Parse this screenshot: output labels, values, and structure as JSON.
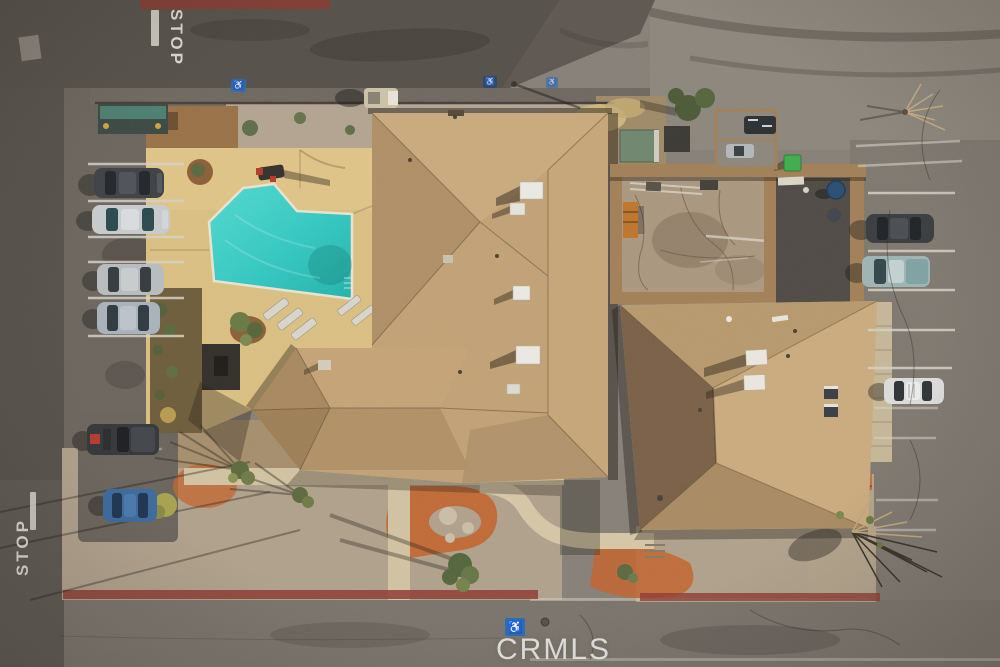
{
  "scene": {
    "description": "Aerial drone view of a motel property: swimming pool with tan deck, large hip-roof building, walled service courtyard, second hip-roof building, perimeter parking lots with cars, desert landscaping with orange ground cover",
    "watermark": "CRMLS"
  },
  "markings": {
    "stop_top": "STOP",
    "stop_bottom": "STOP",
    "accessible_icon": "♿"
  },
  "site_colors": {
    "pool_water": "#35c9c2",
    "pool_deck": "#dcc083",
    "roof_shingle": "#c3a276",
    "roof_shadow_facet": "#7b6148",
    "gravel": "#b1a28c",
    "ground_cover_orange": "#c4652f",
    "curb_red": "#8f3c32",
    "asphalt_dark": "#56514a",
    "asphalt_light": "#878178",
    "accessible_blue": "#2e6db4",
    "bin_green": "#3fae4e",
    "barrel_blue": "#2a4e73"
  },
  "vehicles": {
    "left_row": [
      "dark gray SUV",
      "silver sedan",
      "silver crossover",
      "light blue-silver sedan",
      "dark pickup with red cargo",
      "blue sedan"
    ],
    "right_row": [
      "dark gray SUV",
      "teal-silver pickup",
      "white sedan"
    ],
    "misc": [
      "tan utility cart on north walk",
      "service carts in north-east enclosure"
    ]
  }
}
